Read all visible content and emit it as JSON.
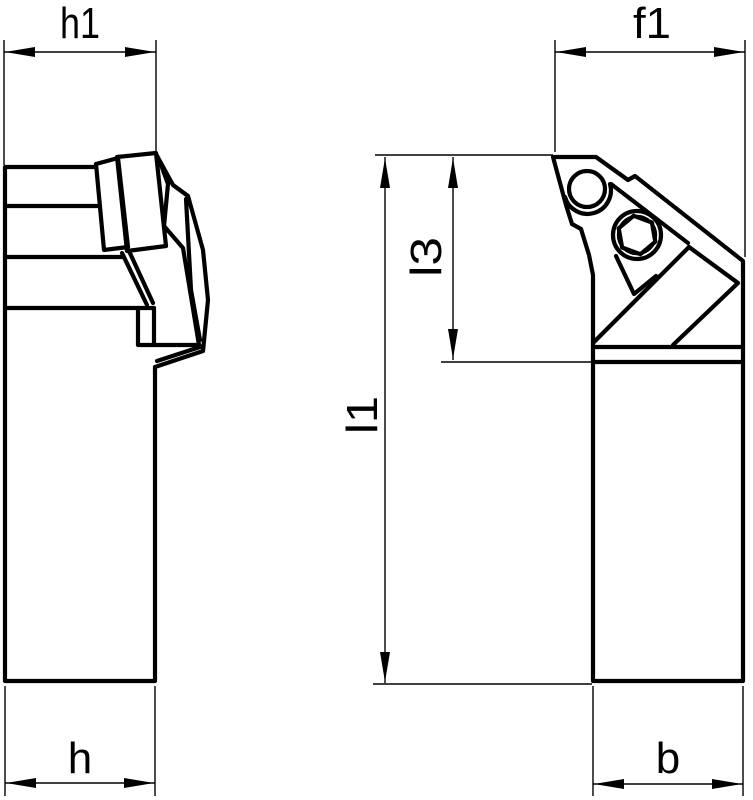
{
  "drawing": {
    "type": "technical-drawing",
    "description": "Lathe turning tool holder shown in two orthographic views with dimension annotations",
    "background_color": "#ffffff",
    "line_color": "#000000",
    "views": {
      "left": "side view of tool holder with clamp",
      "right": "front view of tool holder with insert, clamp screw and hex socket screw"
    },
    "dimensions": {
      "h1": {
        "label": "h1"
      },
      "f1": {
        "label": "f1"
      },
      "l3": {
        "label": "l3"
      },
      "l1": {
        "label": "l1"
      },
      "h": {
        "label": "h"
      },
      "b": {
        "label": "b"
      }
    }
  }
}
